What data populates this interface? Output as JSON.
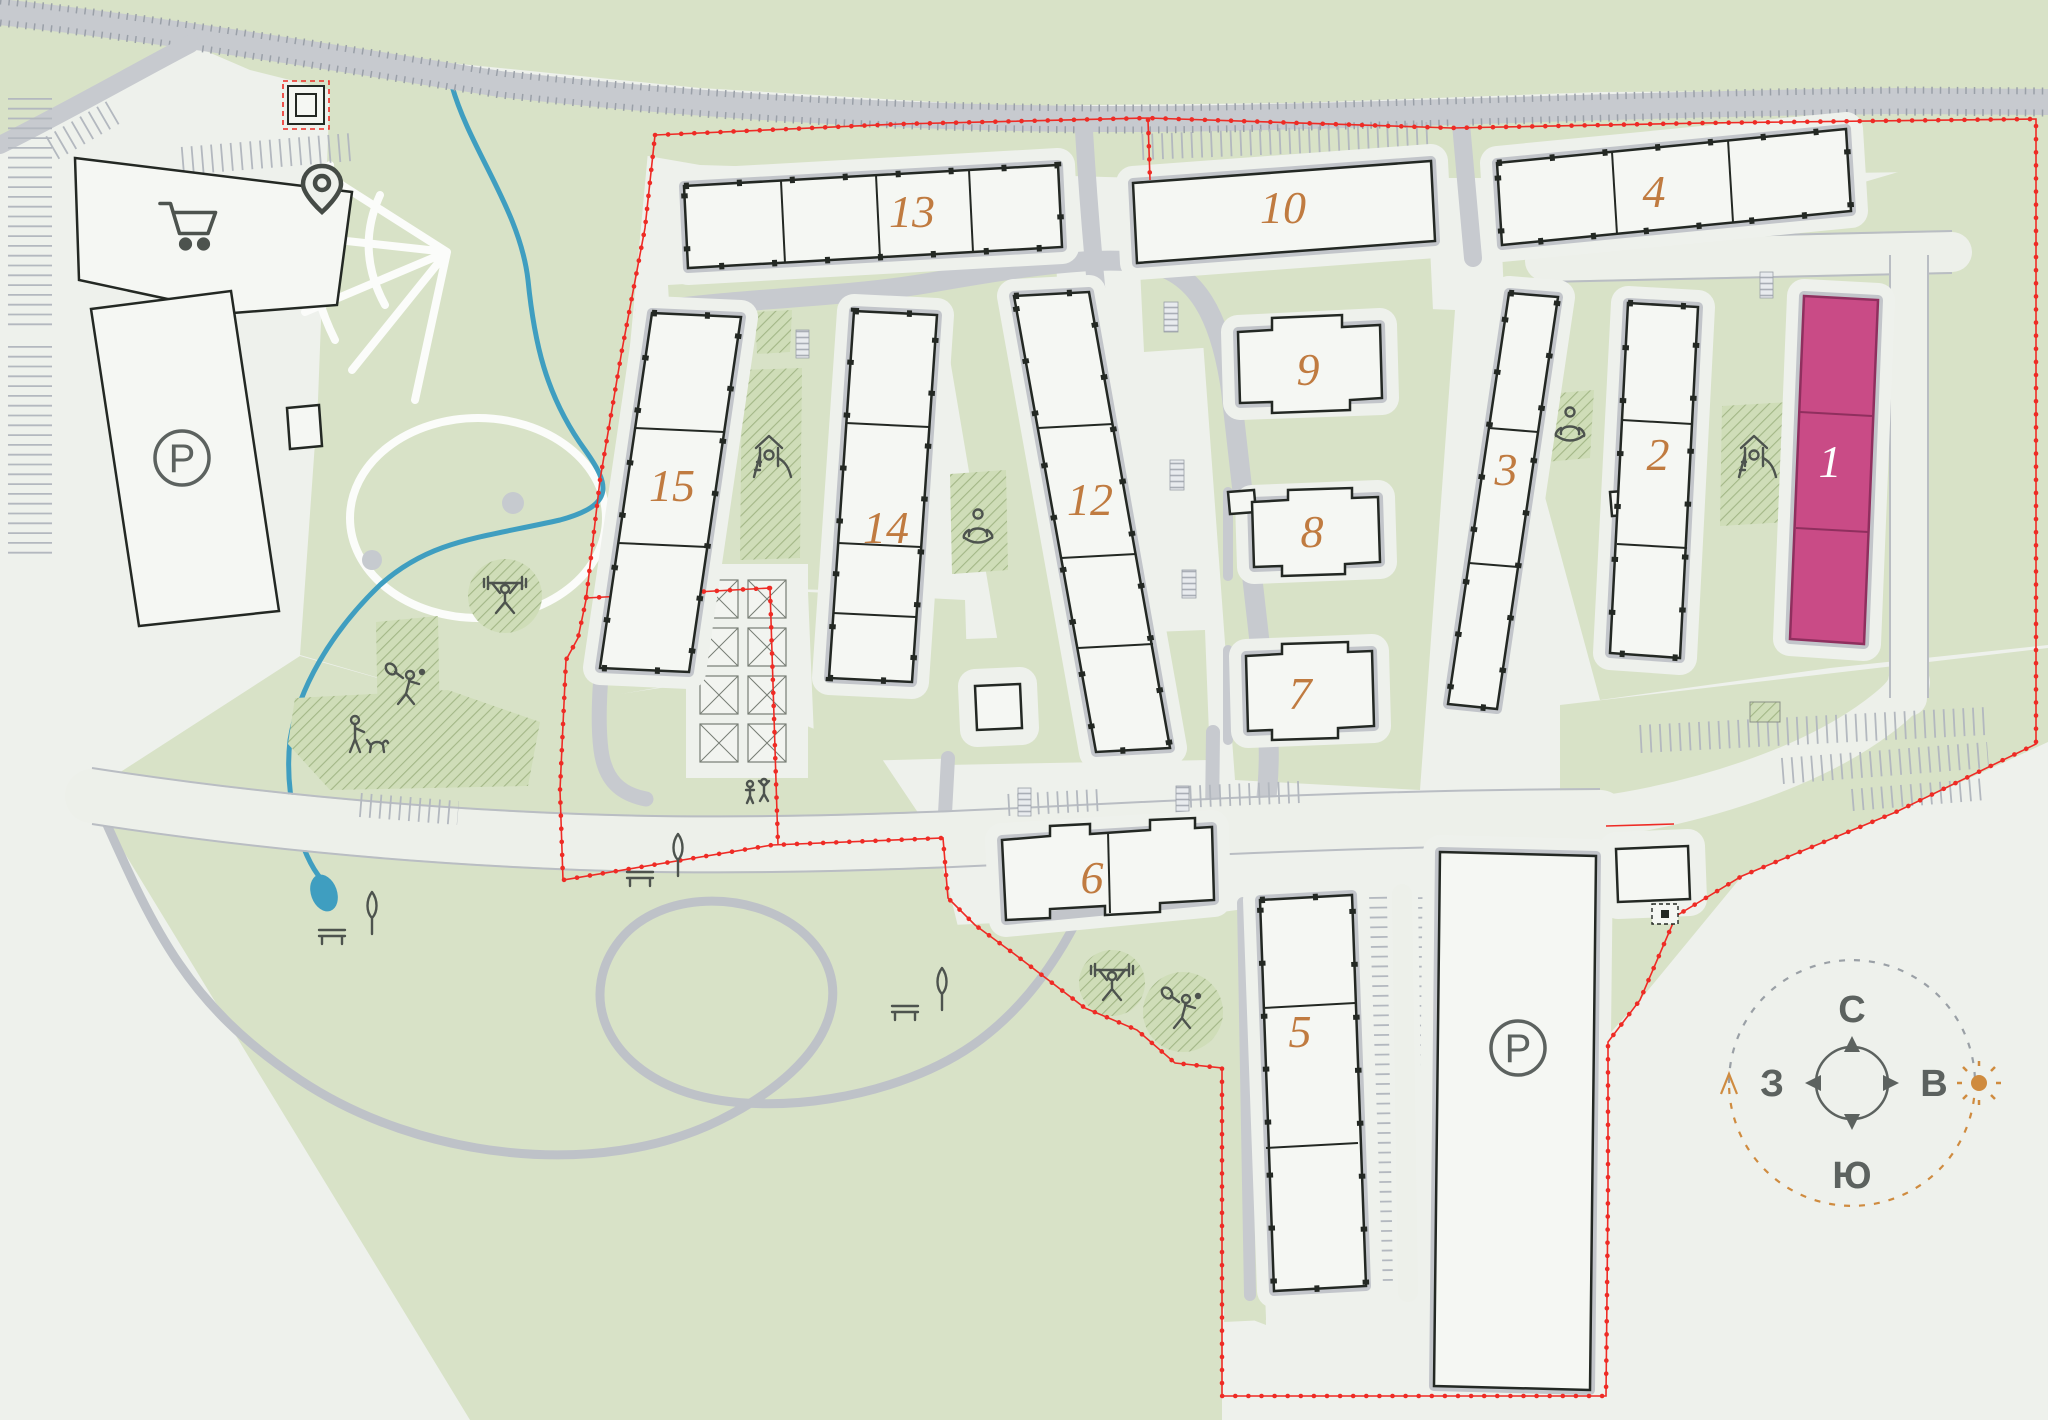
{
  "title": "Residential complex master plan",
  "colors": {
    "background": "#eef1ec",
    "green": "#d8e2c7",
    "hatch_green": "#cfddb8",
    "road_gray": "#c7cacf",
    "building_fill": "#f5f7f3",
    "building_stroke": "#232823",
    "highlight_pink": "#c94b86",
    "number_orange": "#c07b40",
    "boundary_red": "#ee2b25",
    "water_blue": "#3f9ec0",
    "icon_gray": "#4d534e",
    "compass_orange": "#cf8b3f"
  },
  "buildings": {
    "b1": {
      "id": 1,
      "label": "1",
      "highlighted": true
    },
    "b2": {
      "id": 2,
      "label": "2",
      "highlighted": false
    },
    "b3": {
      "id": 3,
      "label": "3",
      "highlighted": false
    },
    "b4": {
      "id": 4,
      "label": "4",
      "highlighted": false
    },
    "b5": {
      "id": 5,
      "label": "5",
      "highlighted": false
    },
    "b6": {
      "id": 6,
      "label": "6",
      "highlighted": false
    },
    "b7": {
      "id": 7,
      "label": "7",
      "highlighted": false
    },
    "b8": {
      "id": 8,
      "label": "8",
      "highlighted": false
    },
    "b9": {
      "id": 9,
      "label": "9",
      "highlighted": false
    },
    "b10": {
      "id": 10,
      "label": "10",
      "highlighted": false
    },
    "b12": {
      "id": 12,
      "label": "12",
      "highlighted": false
    },
    "b13": {
      "id": 13,
      "label": "13",
      "highlighted": false
    },
    "b14": {
      "id": 14,
      "label": "14",
      "highlighted": false
    },
    "b15": {
      "id": 15,
      "label": "15",
      "highlighted": false
    }
  },
  "parking": {
    "label": "P",
    "visible_badges": 2
  },
  "compass": {
    "north": "С",
    "east": "В",
    "south": "Ю",
    "west": "З"
  },
  "amenities": [
    "shopping-cart",
    "location-pin",
    "playground-slide",
    "yoga",
    "weightlifting",
    "badminton",
    "dog-walking",
    "bench",
    "cypress-tree",
    "kids-playing"
  ]
}
